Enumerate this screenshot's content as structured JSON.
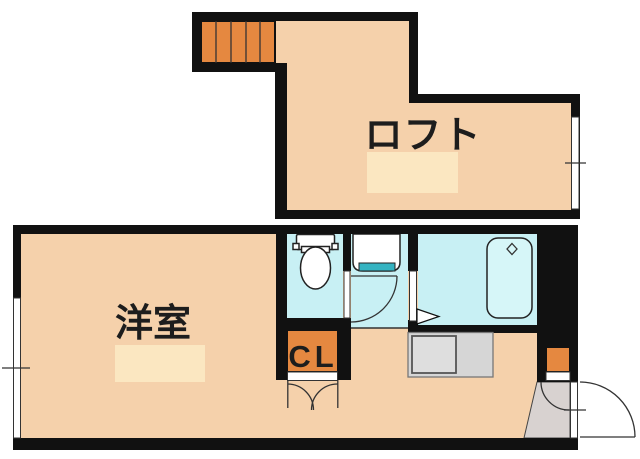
{
  "plan": {
    "type": "apartment-floor-plan",
    "rooms": {
      "loft": {
        "label": "ロフト"
      },
      "western_room": {
        "label": "洋室"
      },
      "closet": {
        "label": "CL"
      }
    },
    "fixtures": [
      "stairs-icon",
      "toilet-icon",
      "washbasin-icon",
      "bathtub-icon",
      "faucet-diamond-icon",
      "step-arrow-icon",
      "kitchen-counter-icon",
      "closet-double-doors-icon",
      "entrance-door-arc-icon",
      "shoe-cabinet-icon",
      "window-icon"
    ],
    "colors": {
      "wall": "#111111",
      "floor": "#f5d1ab",
      "floor_highlight": "#fbe7c1",
      "wet_area": "#c8f0f4",
      "tub_fill": "#d6f6f8",
      "accent_orange": "#e58840",
      "entrance_floor": "#d8d2d0",
      "counter_gray": "#d6d6d6",
      "counter_inner": "#dedede",
      "fixture_teal": "#35b3c1"
    }
  }
}
